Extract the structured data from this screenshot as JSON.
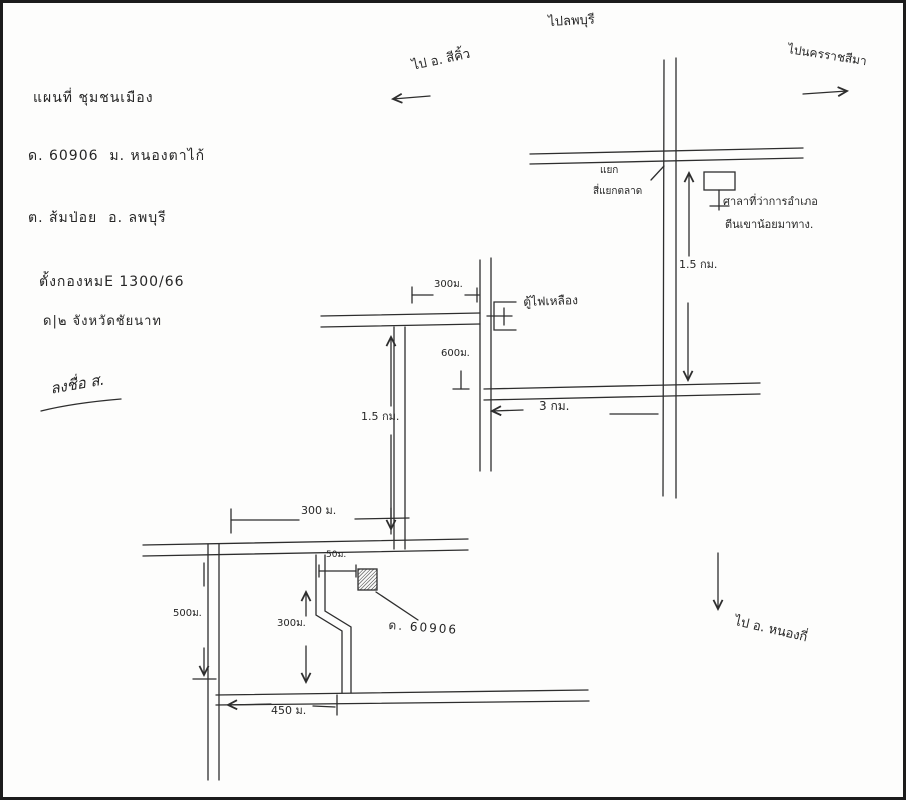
{
  "canvas": {
    "width": 906,
    "height": 800,
    "background": "#fdfdfc",
    "ink_color": "#2e2e2e"
  },
  "title_block": {
    "line1": "แผนที่ ชุมชนเมือง",
    "line2": "ด. 60906  ม. หนองตาไก้",
    "line3": "ต. ส้มป่อย  อ. ลพบุรี",
    "line4": "ตั้งกองหมE 1300/66",
    "line5": "ด|๒ จังหวัดชัยนาท",
    "signature": "ลงชื่อ ส."
  },
  "directions": {
    "north": "ไปลพบุรี",
    "northeast": "ไปนครราชสีมา",
    "west": "ไป อ. สีคิ้ว",
    "south": "ไป อ. หนองกี่"
  },
  "landmarks": {
    "junction_line1": "แยก",
    "junction_line2": "สี่แยกตลาด",
    "office_line1": "ศาลาที่ว่าการอำเภอ",
    "office_line2": "ตีนเขาน้อยมาทาง.",
    "signal_box": "ตู้ไฟเหลือง",
    "incident_house": "ด. 60906"
  },
  "measurements": {
    "right_road": "1.5 กม.",
    "cross_road": "3 กม.",
    "upper_branch": "300ม.",
    "mid_branch": "600ม.",
    "left_road": "1.5 กม.",
    "main_road": "300 ม.",
    "west_road": "500ม.",
    "driveway": "50ม.",
    "zigzag_road": "300ม.",
    "bottom_road": "450 ม."
  }
}
